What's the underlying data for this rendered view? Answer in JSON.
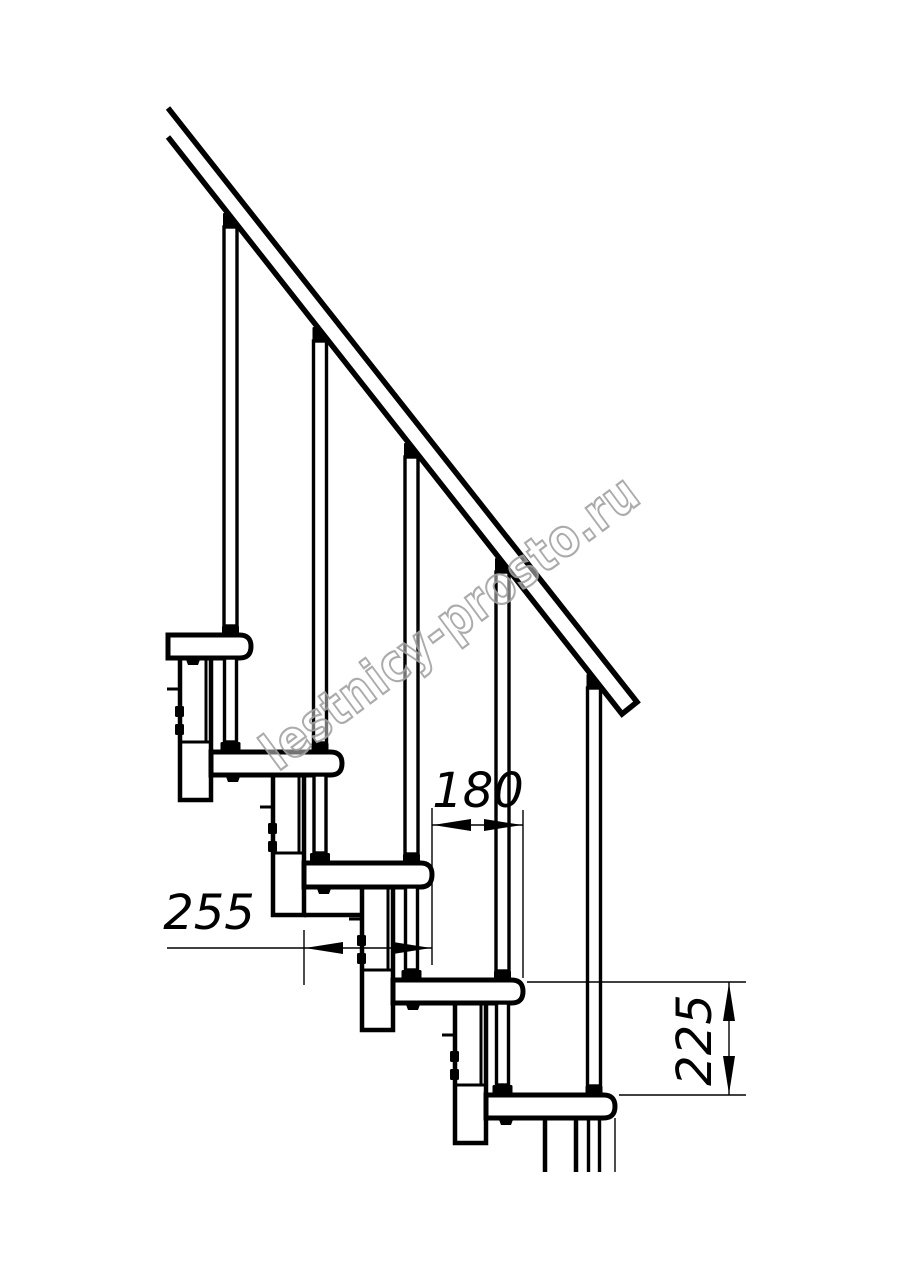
{
  "colors": {
    "line": "#000000",
    "background": "#ffffff",
    "watermark": "#a3a3a3"
  },
  "watermark": {
    "text": "lestnicy-prosto.ru"
  },
  "dims": {
    "run": {
      "value": "180"
    },
    "depth": {
      "value": "255"
    },
    "riser": {
      "value": "225"
    }
  }
}
